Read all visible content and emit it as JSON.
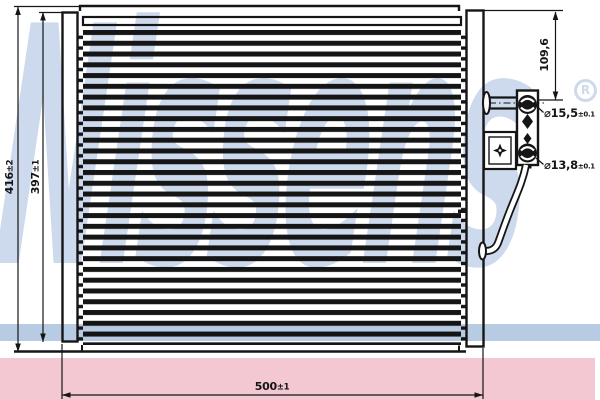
{
  "watermark": {
    "brand": "Nissens",
    "registered_mark": "R"
  },
  "dimensions": {
    "overall_height": {
      "value": "416",
      "tolerance": "±2"
    },
    "core_height": {
      "value": "397",
      "tolerance": "±1"
    },
    "overall_width": {
      "value": "500",
      "tolerance": "±1"
    },
    "top_port_offset": {
      "value": "109,6"
    },
    "top_port_diameter": {
      "symbol": "⌀",
      "value": "15,5",
      "tolerance": "±0.1"
    },
    "bottom_port_diameter": {
      "symbol": "⌀",
      "value": "13,8",
      "tolerance": "±0.1"
    }
  },
  "colors": {
    "line_ink": "#151515",
    "watermark_blue": "#cdd9ec",
    "swoosh_blue": "#b7cbe3",
    "accent_pink": "#f3c8d2",
    "background": "#ffffff"
  }
}
